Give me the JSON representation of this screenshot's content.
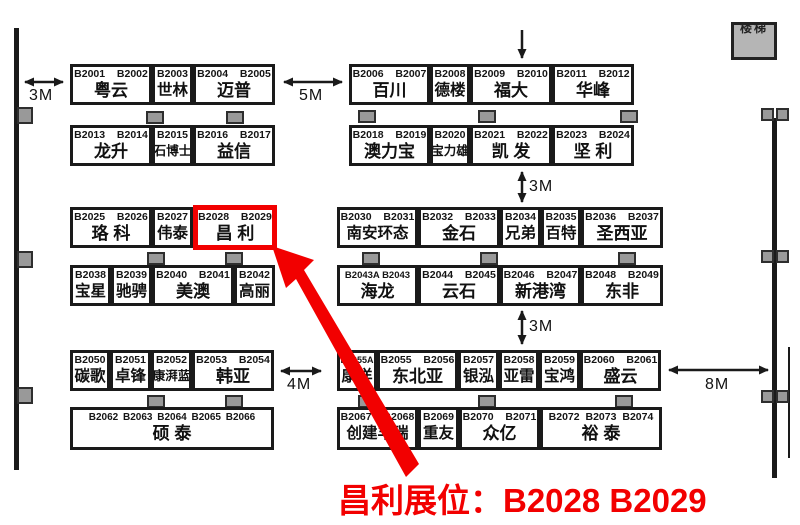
{
  "map": {
    "caption": "昌利展位：B2028 B2029",
    "stairs_label": "楼梯",
    "colors": {
      "highlight": "#f20000",
      "line": "#1a1a1a",
      "pillar": "#999999",
      "stairs_fill": "#b5b5b5"
    },
    "distances": {
      "left_3m": "3M",
      "mid_5m": "5M",
      "right_gap_top_3m": "3M",
      "right_gap_bottom_3m": "3M",
      "left_4m": "4M",
      "right_8m": "8M"
    },
    "booths": [
      {
        "numbers": "B2001  B2002",
        "name": "粤云"
      },
      {
        "numbers": "B2003",
        "name": "世林"
      },
      {
        "numbers": "B2004  B2005",
        "name": "迈普"
      },
      {
        "numbers": "B2006  B2007",
        "name": "百川"
      },
      {
        "numbers": "B2008",
        "name": "德楼"
      },
      {
        "numbers": "B2009  B2010",
        "name": "福大"
      },
      {
        "numbers": "B2011  B2012",
        "name": "华峰"
      },
      {
        "numbers": "B2013  B2014",
        "name": "龙升"
      },
      {
        "numbers": "B2015",
        "name": "石博士"
      },
      {
        "numbers": "B2016  B2017",
        "name": "益信"
      },
      {
        "numbers": "B2018  B2019",
        "name": "澳力宝"
      },
      {
        "numbers": "B2020",
        "name": "宝力雄"
      },
      {
        "numbers": "B2021  B2022",
        "name": "凯 发"
      },
      {
        "numbers": "B2023  B2024",
        "name": "坚 利"
      },
      {
        "numbers": "B2025  B2026",
        "name": "珞 科"
      },
      {
        "numbers": "B2027",
        "name": "伟泰"
      },
      {
        "numbers": "B2028  B2029",
        "name": "昌 利"
      },
      {
        "numbers": "B2030  B2031",
        "name": "南安环态"
      },
      {
        "numbers": "B2032  B2033",
        "name": "金石"
      },
      {
        "numbers": "B2034",
        "name": "兄弟"
      },
      {
        "numbers": "B2035",
        "name": "百特"
      },
      {
        "numbers": "B2036  B2037",
        "name": "圣西亚"
      },
      {
        "numbers": "B2038",
        "name": "宝星"
      },
      {
        "numbers": "B2039",
        "name": "驰骋"
      },
      {
        "numbers": "B2040  B2041",
        "name": "美澳"
      },
      {
        "numbers": "B2042",
        "name": "高丽"
      },
      {
        "numbers": "B2043A B2043",
        "name": "海龙"
      },
      {
        "numbers": "B2044  B2045",
        "name": "云石"
      },
      {
        "numbers": "B2046  B2047",
        "name": "新港湾"
      },
      {
        "numbers": "B2048  B2049",
        "name": "东非"
      },
      {
        "numbers": "B2050",
        "name": "碳歌"
      },
      {
        "numbers": "B2051",
        "name": "卓锋"
      },
      {
        "numbers": "B2052",
        "name": "康湃蓝"
      },
      {
        "numbers": "B2053  B2054",
        "name": "韩亚"
      },
      {
        "numbers": "B2055A",
        "name": "康洋"
      },
      {
        "numbers": "B2055  B2056",
        "name": "东北亚"
      },
      {
        "numbers": "B2057",
        "name": "银泓"
      },
      {
        "numbers": "B2058",
        "name": "亚雷"
      },
      {
        "numbers": "B2059",
        "name": "宝鸿"
      },
      {
        "numbers": "B2060  B2061",
        "name": "盛云"
      },
      {
        "numbers": "B2062 B2063 B2064 B2065 B2066",
        "name": "硕 泰"
      },
      {
        "numbers": "B2067  B2068",
        "name": "创建丰瑞"
      },
      {
        "numbers": "B2069",
        "name": "重友"
      },
      {
        "numbers": "B2070  B2071",
        "name": "众亿"
      },
      {
        "numbers": "B2072 B2073 B2074",
        "name": "裕 泰"
      }
    ]
  }
}
